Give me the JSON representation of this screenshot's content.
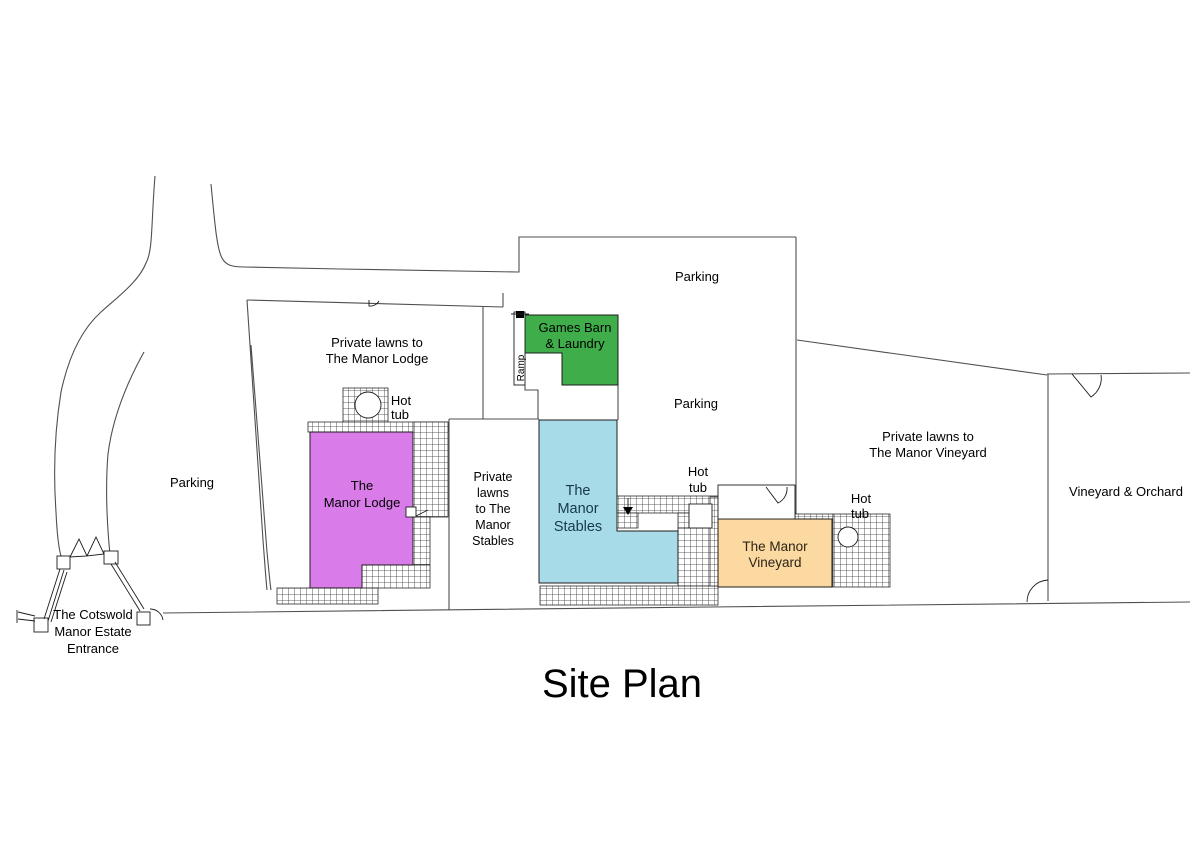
{
  "title": "Site Plan",
  "colors": {
    "lodge": "#d97be8",
    "stables": "#a7dbe8",
    "games_barn": "#3fad49",
    "vineyard": "#fbd9a1"
  },
  "labels": {
    "entrance": [
      "The Cotswold",
      "Manor Estate",
      "Entrance"
    ],
    "parking_west": "Parking",
    "parking_north": "Parking",
    "parking_central": "Parking",
    "lodge_lawns": [
      "Private lawns to",
      "The Manor Lodge"
    ],
    "lodge": [
      "The",
      "Manor Lodge"
    ],
    "hot_tub": [
      "Hot",
      "tub"
    ],
    "games_barn": [
      "Games Barn",
      "& Laundry"
    ],
    "ramp": "Ramp",
    "stables_lawns": [
      "Private",
      "lawns",
      "to The",
      "Manor",
      "Stables"
    ],
    "stables": [
      "The",
      "Manor",
      "Stables"
    ],
    "vineyard": [
      "The Manor",
      "Vineyard"
    ],
    "vineyard_lawns": [
      "Private lawns to",
      "The Manor Vineyard"
    ],
    "orchard": "Vineyard & Orchard"
  }
}
